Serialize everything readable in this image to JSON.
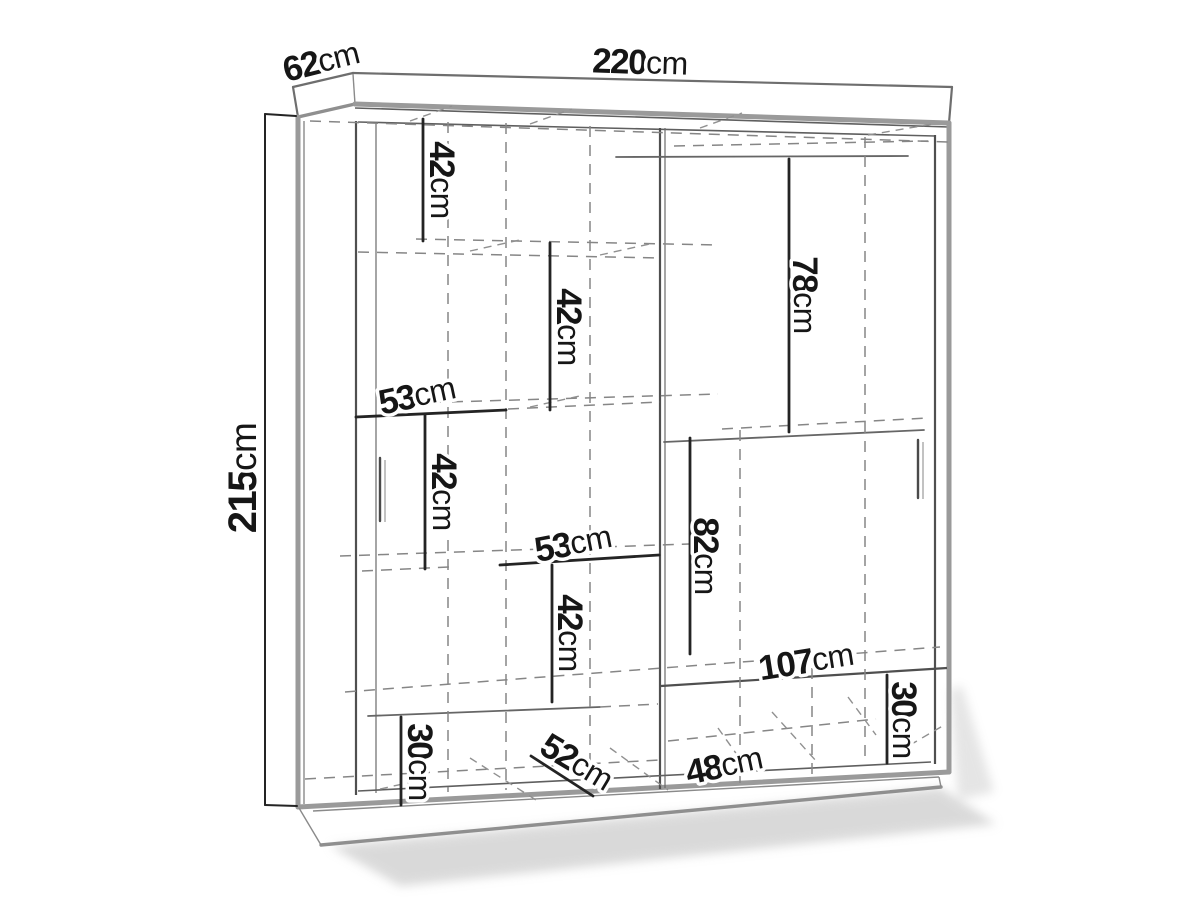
{
  "diagram": {
    "type": "furniture-dimension-drawing",
    "subject": "two-door sliding wardrobe, front axonometric view with internal shelf layout",
    "unit": "cm",
    "colors": {
      "background": "#ffffff",
      "line": "#6e6e6e",
      "dimension_text": "#161616",
      "shadow": "#b5b5b5"
    },
    "dims": {
      "overall_width": {
        "value": "220",
        "unit": "cm"
      },
      "overall_depth": {
        "value": "62",
        "unit": "cm"
      },
      "overall_height": {
        "value": "215",
        "unit": "cm"
      },
      "left_gap_top": {
        "value": "42",
        "unit": "cm"
      },
      "left_gap_second": {
        "value": "42",
        "unit": "cm"
      },
      "shelf_width_upper": {
        "value": "53",
        "unit": "cm"
      },
      "left_gap_third": {
        "value": "42",
        "unit": "cm"
      },
      "shelf_width_lower": {
        "value": "53",
        "unit": "cm"
      },
      "left_gap_fourth": {
        "value": "42",
        "unit": "cm"
      },
      "hanging_height_upper": {
        "value": "78",
        "unit": "cm"
      },
      "hanging_height_lower": {
        "value": "82",
        "unit": "cm"
      },
      "bottom_section_width": {
        "value": "107",
        "unit": "cm"
      },
      "bottom_height_right": {
        "value": "30",
        "unit": "cm"
      },
      "bottom_inner_width": {
        "value": "48",
        "unit": "cm"
      },
      "bottom_height_left": {
        "value": "30",
        "unit": "cm"
      },
      "interior_depth": {
        "value": "52",
        "unit": "cm"
      }
    }
  }
}
